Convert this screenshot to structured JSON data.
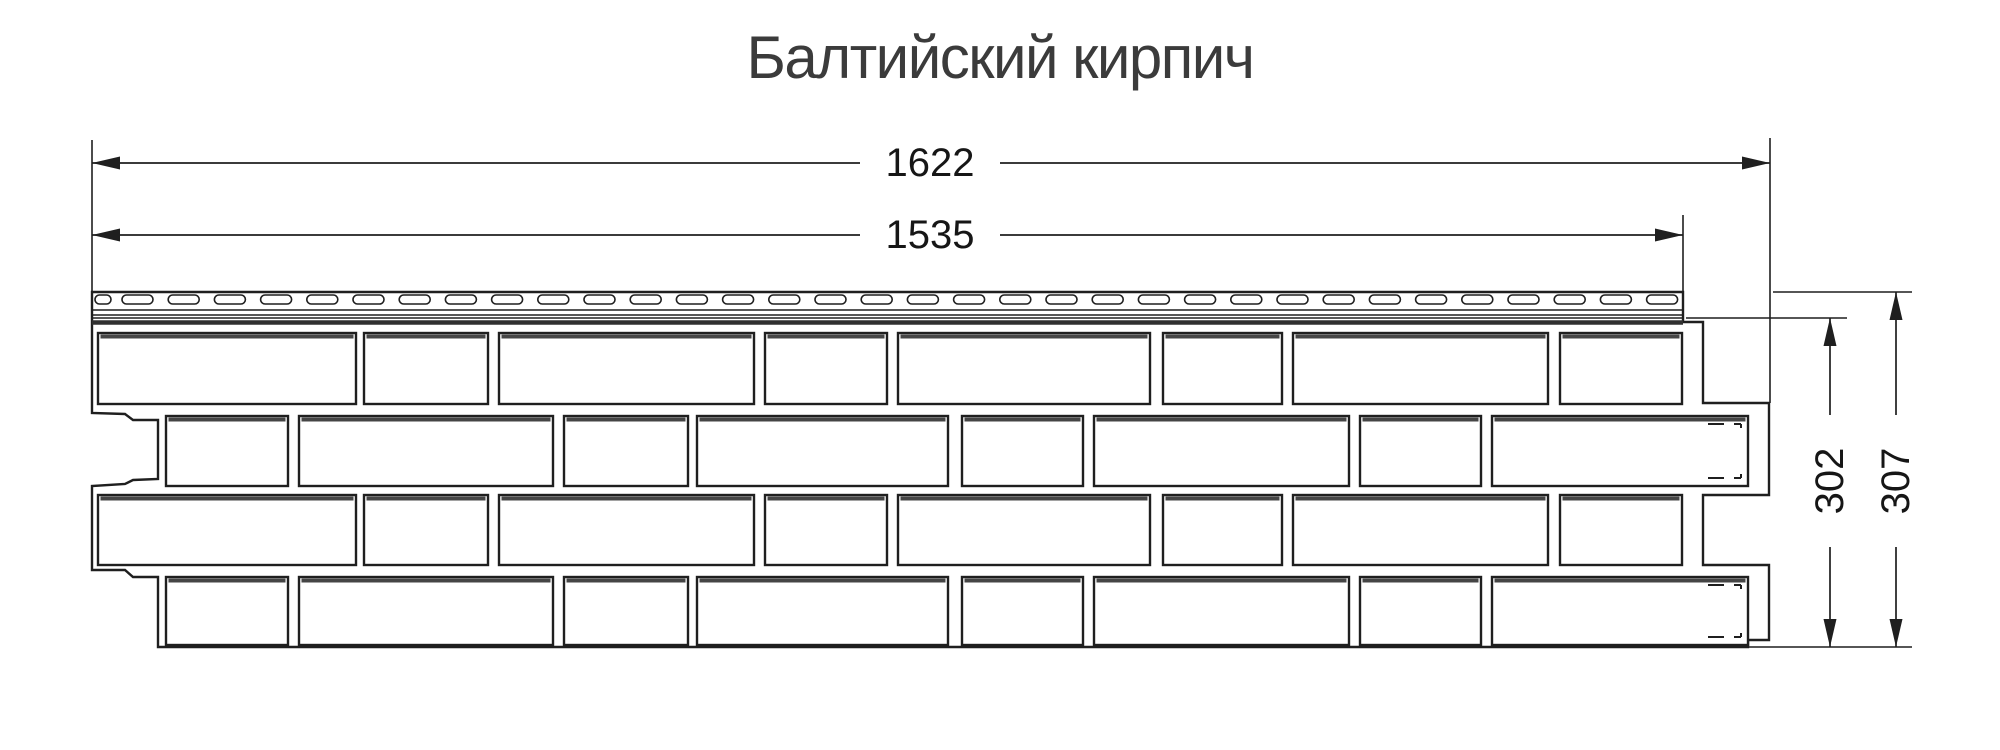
{
  "title": "Балтийский кирпич",
  "colors": {
    "line": "#1f1f1f",
    "accent": "#454545",
    "title": "#3b3b3b",
    "background": "#ffffff"
  },
  "dimensions": {
    "full_width": {
      "value": "1622"
    },
    "nail_width": {
      "value": "1535"
    },
    "face_height": {
      "value": "302"
    },
    "full_height": {
      "value": "307"
    }
  },
  "drawing_data": {
    "type": "dimensioned-technical-drawing",
    "subject": "facade-siding-panel-baltic-brick",
    "outline": [
      [
        92,
        292
      ],
      [
        1683,
        292
      ],
      [
        1683,
        322
      ],
      [
        1703,
        322
      ],
      [
        1703,
        403
      ],
      [
        1769,
        403
      ],
      [
        1769,
        495
      ],
      [
        1703,
        495
      ],
      [
        1703,
        565
      ],
      [
        1769,
        565
      ],
      [
        1769,
        640
      ],
      [
        1748,
        640
      ],
      [
        1748,
        647
      ],
      [
        158,
        647
      ],
      [
        158,
        577
      ],
      [
        133,
        577
      ],
      [
        125,
        570
      ],
      [
        92,
        570
      ],
      [
        92,
        486
      ],
      [
        125,
        484
      ],
      [
        133,
        480
      ],
      [
        158,
        479
      ],
      [
        158,
        420
      ],
      [
        133,
        420
      ],
      [
        125,
        414
      ],
      [
        92,
        413
      ]
    ],
    "hem": {
      "x0": 92,
      "x1": 1683,
      "lines": [
        310,
        315,
        318
      ],
      "band_y": 322.5,
      "slots": {
        "y": 295,
        "h": 9,
        "rx": 4.5,
        "first": [
          95,
          111
        ],
        "start": 122,
        "width": 31,
        "pitch": 46.2,
        "end": 1680
      }
    },
    "rows": [
      {
        "y": 333,
        "h": 71,
        "notch_last": false,
        "bricks": [
          [
            98,
            356
          ],
          [
            364,
            488
          ],
          [
            499,
            754
          ],
          [
            765,
            887
          ],
          [
            898,
            1150
          ],
          [
            1163,
            1282
          ],
          [
            1293,
            1548
          ],
          [
            1560,
            1682
          ]
        ]
      },
      {
        "y": 416,
        "h": 70,
        "notch_last": true,
        "bricks": [
          [
            166,
            288
          ],
          [
            299,
            553
          ],
          [
            564,
            688
          ],
          [
            697,
            948
          ],
          [
            962,
            1083
          ],
          [
            1094,
            1349
          ],
          [
            1360,
            1481
          ],
          [
            1492,
            1748
          ]
        ]
      },
      {
        "y": 495,
        "h": 70,
        "notch_last": false,
        "bricks": [
          [
            98,
            356
          ],
          [
            364,
            488
          ],
          [
            499,
            754
          ],
          [
            765,
            887
          ],
          [
            898,
            1150
          ],
          [
            1163,
            1282
          ],
          [
            1293,
            1548
          ],
          [
            1560,
            1682
          ]
        ]
      },
      {
        "y": 577,
        "h": 68,
        "notch_last": true,
        "bricks": [
          [
            166,
            288
          ],
          [
            299,
            553
          ],
          [
            564,
            688
          ],
          [
            697,
            948
          ],
          [
            962,
            1083
          ],
          [
            1094,
            1349
          ],
          [
            1360,
            1481
          ],
          [
            1492,
            1748
          ]
        ]
      }
    ],
    "ext_lines": [
      [
        92,
        140,
        92,
        292
      ],
      [
        1770,
        138,
        1770,
        403
      ],
      [
        1683,
        215,
        1683,
        292
      ],
      [
        1773,
        292,
        1912,
        292
      ],
      [
        1686,
        318,
        1847,
        318
      ],
      [
        1748,
        647,
        1912,
        647
      ]
    ],
    "dims": [
      {
        "type": "h",
        "y": 163,
        "x1": 92,
        "x2": 1770,
        "key": "full_width"
      },
      {
        "type": "h",
        "y": 235,
        "x1": 92,
        "x2": 1683,
        "key": "nail_width"
      },
      {
        "type": "v",
        "x": 1830,
        "y1": 318,
        "y2": 647,
        "key": "face_height"
      },
      {
        "type": "v",
        "x": 1896,
        "y1": 292,
        "y2": 647,
        "key": "full_height"
      }
    ],
    "arrow": {
      "len": 28,
      "half_w": 6.5
    }
  }
}
